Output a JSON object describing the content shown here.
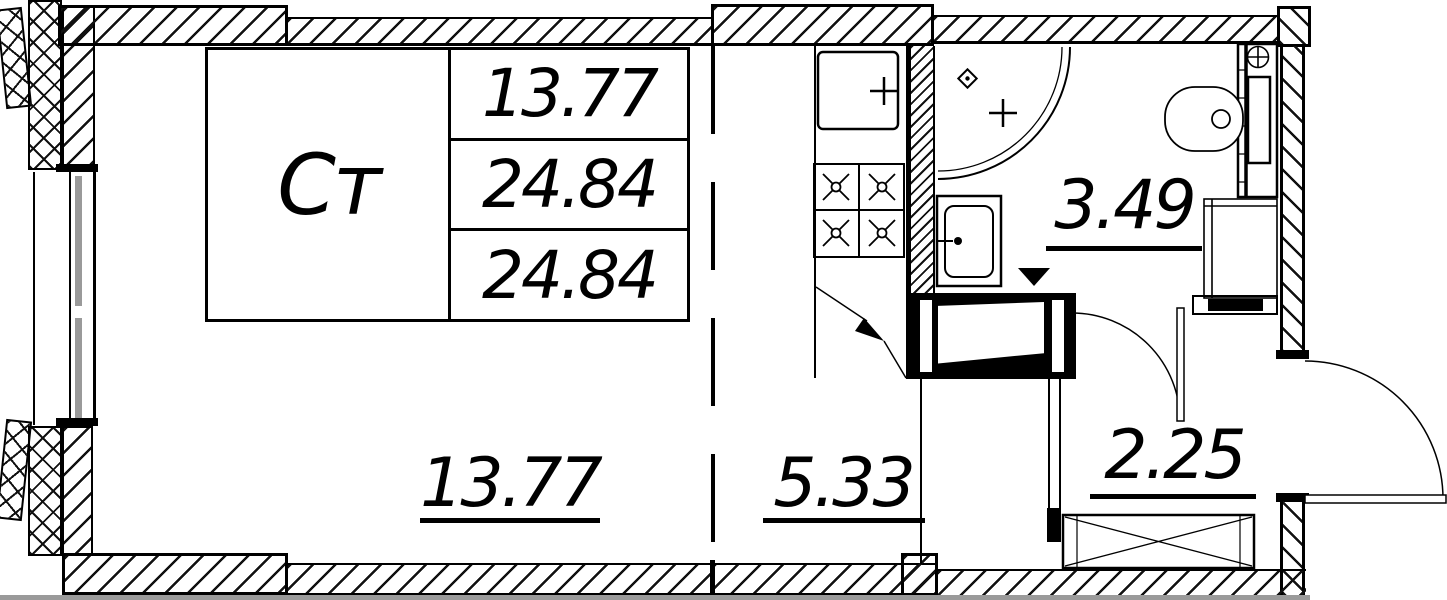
{
  "drawing": {
    "kind": "apartment floor plan (studio)",
    "colors": {
      "line": "#000000",
      "gray": "#9a9a9a",
      "bg": "#ffffff"
    }
  },
  "stamp": {
    "type_label": "Ст",
    "rows": [
      {
        "value": "13.77"
      },
      {
        "value": "24.84"
      },
      {
        "value": "24.84"
      }
    ]
  },
  "rooms": {
    "living": {
      "area": "13.77"
    },
    "kitchen": {
      "area": "5.33"
    },
    "bathroom": {
      "area": "3.49"
    },
    "hall": {
      "area": "2.25"
    }
  },
  "fixtures": [
    "kitchen-sink",
    "stove-4-burners",
    "corner-shower",
    "shower-drain",
    "faucet-cross",
    "wash-basin",
    "toilet",
    "cistern",
    "duct-shaft",
    "vent-symbol",
    "washing-machine",
    "wardrobe",
    "entrance-door",
    "bathroom-door",
    "window",
    "balcony-edge"
  ]
}
